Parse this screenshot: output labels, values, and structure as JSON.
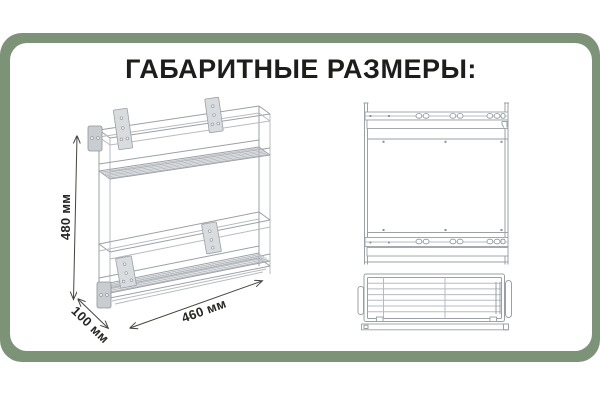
{
  "theme": {
    "page-bg": "#ffffff",
    "frame-green": "#7c9378",
    "card-bg": "#ffffff",
    "title-color": "#1d1d1b",
    "dim-color": "#262624",
    "line-dark": "#45453f",
    "chrome-light": "#b7bbc0",
    "chrome-mid": "#9aa0a6"
  },
  "title": {
    "text": "ГАБАРИТНЫЕ РАЗМЕРЫ:"
  },
  "diagram": {
    "dimensions": {
      "height": "480 мм",
      "depth": "100 мм",
      "width": "460 мм"
    }
  }
}
